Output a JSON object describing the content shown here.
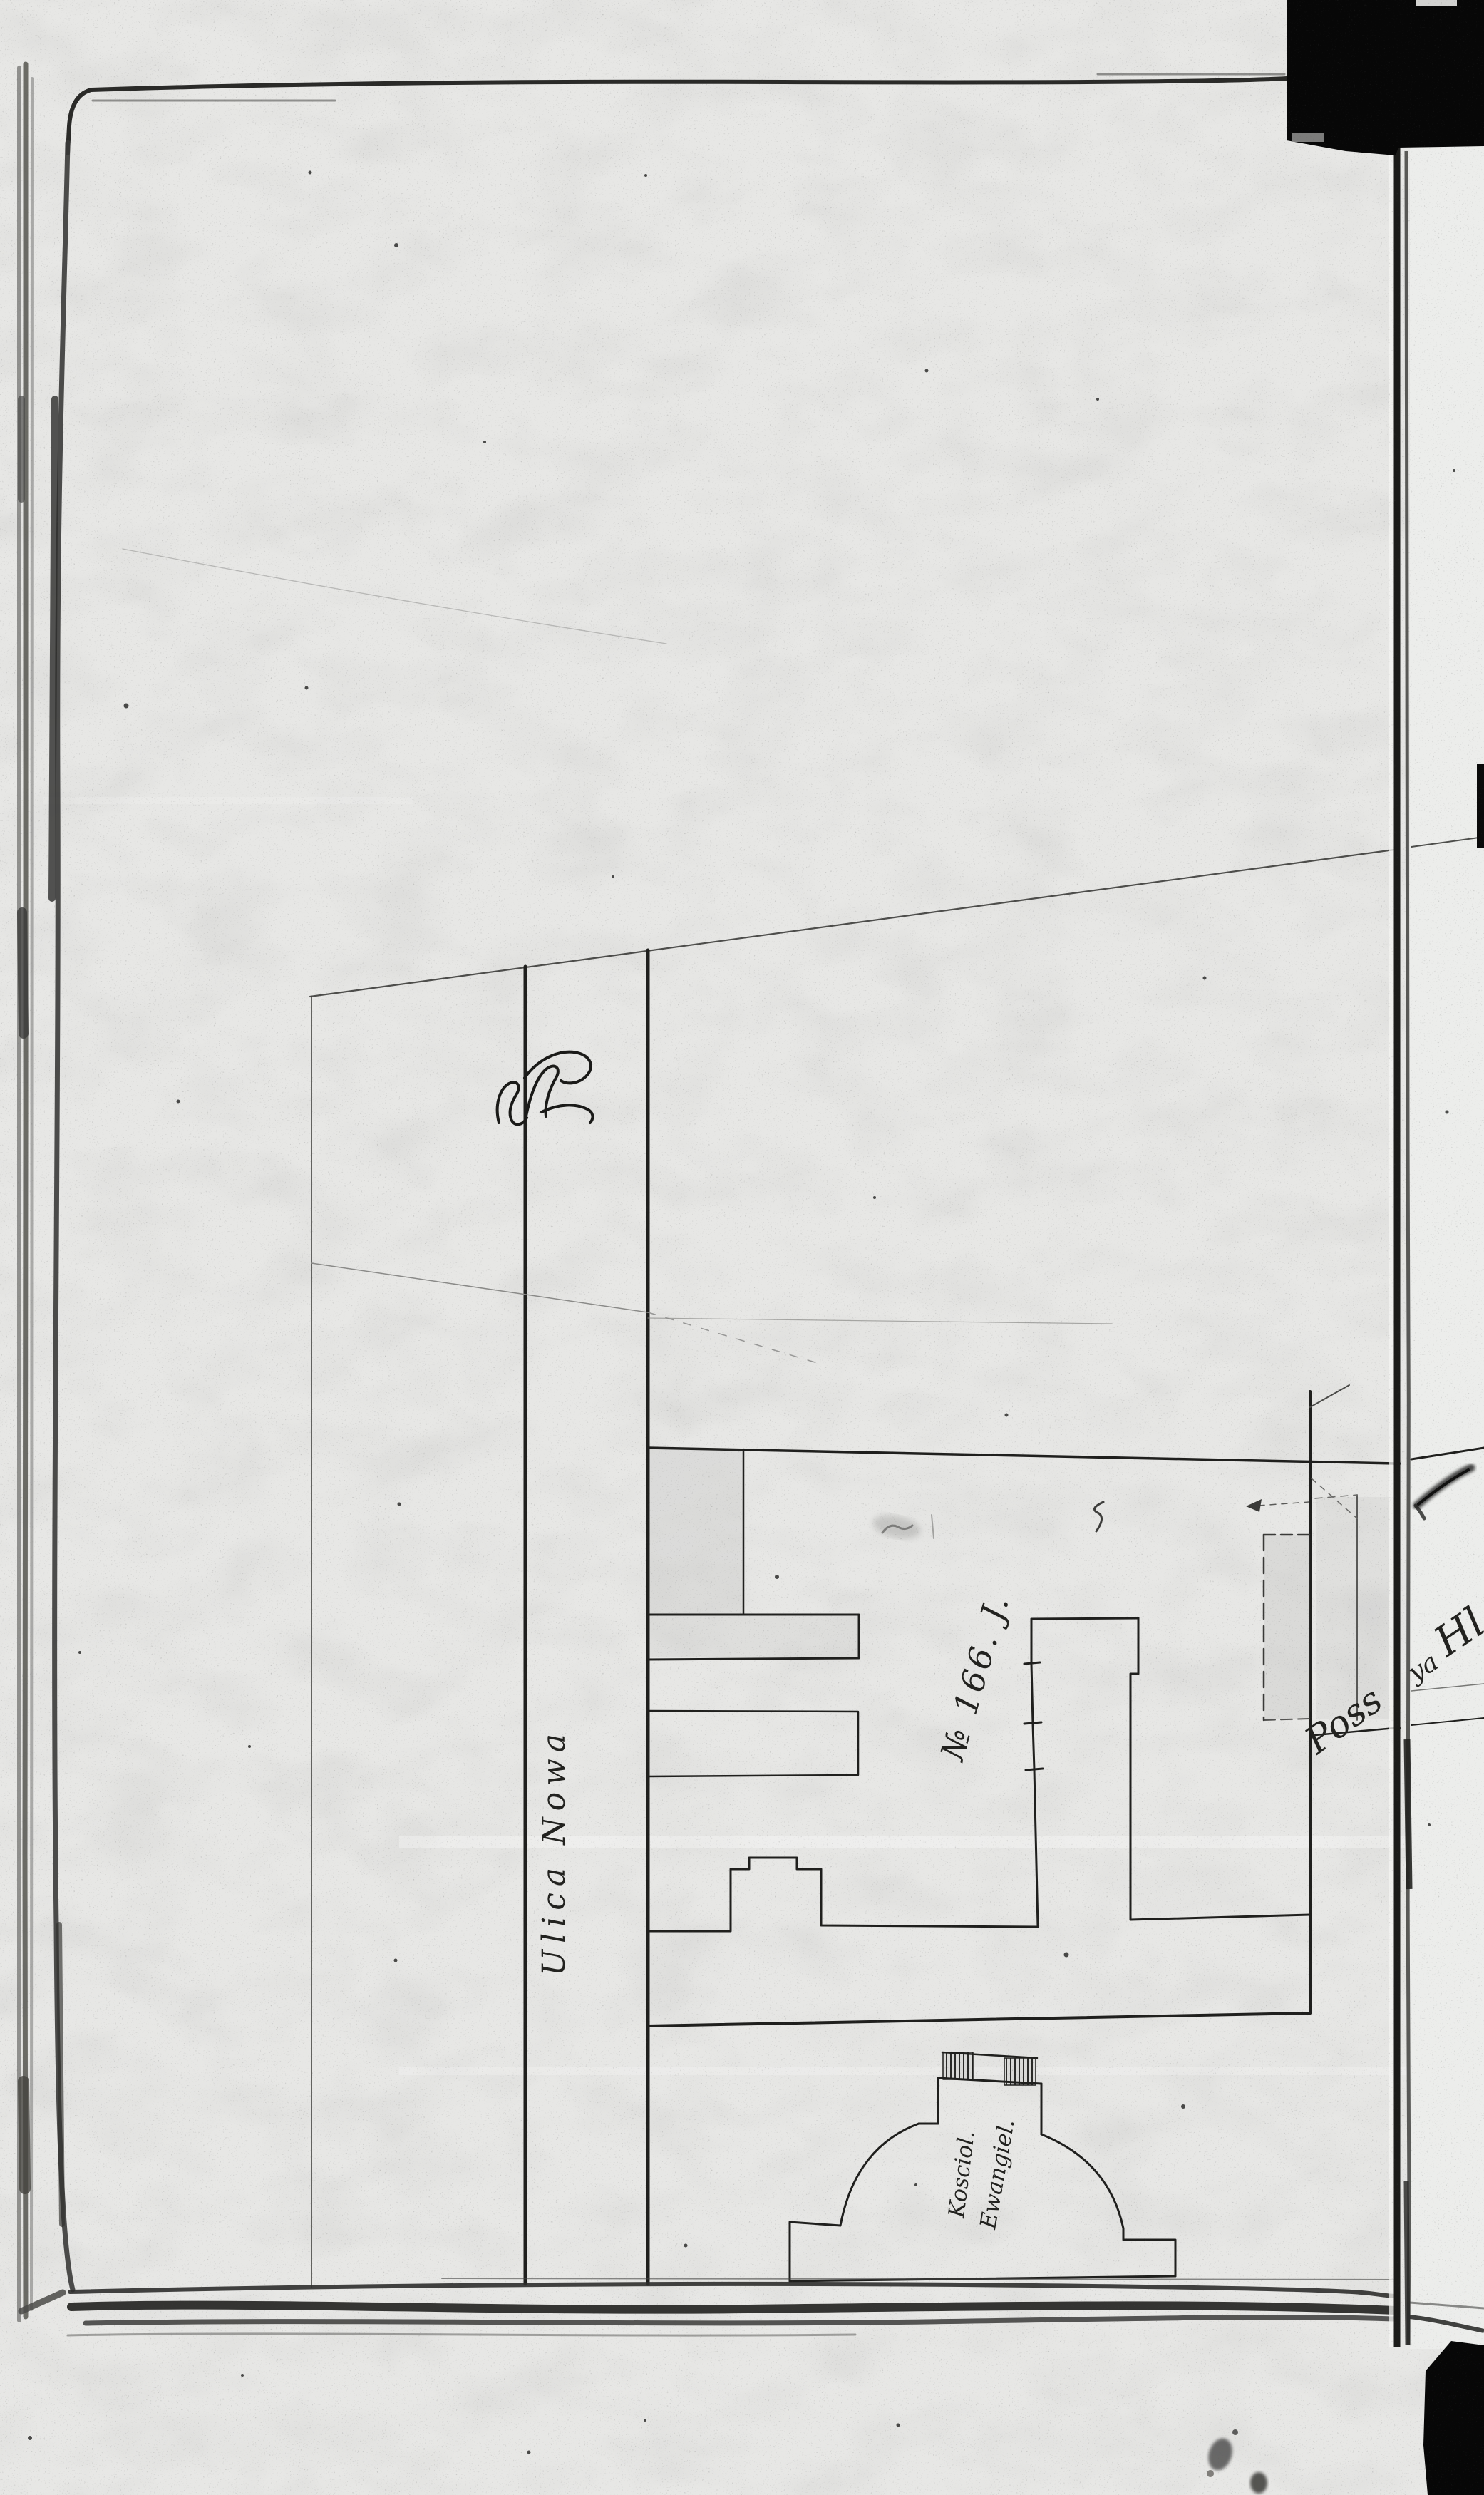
{
  "document": {
    "kind": "scanned archival book page with hand-drawn cadastral site plan",
    "annotations": {
      "street_name": "Ulica  Nowa",
      "parcel_label": "№ 166. J.",
      "church_label_line1": "Kosciol.",
      "church_label_line2": "Ewangiel.",
      "gutter_note_left": "Poss",
      "gutter_note_right_small": "ya",
      "gutter_note_right_large": "Hl",
      "corner_scribble": "Rr"
    },
    "palette": {
      "paper": "#e7e7e5",
      "paper_right_page": "#ecedeb",
      "ink": "#1f1f1d",
      "pencil": "#8a8a88",
      "page_edge": "#2e2e2c",
      "scanner_black": "#070707"
    }
  }
}
